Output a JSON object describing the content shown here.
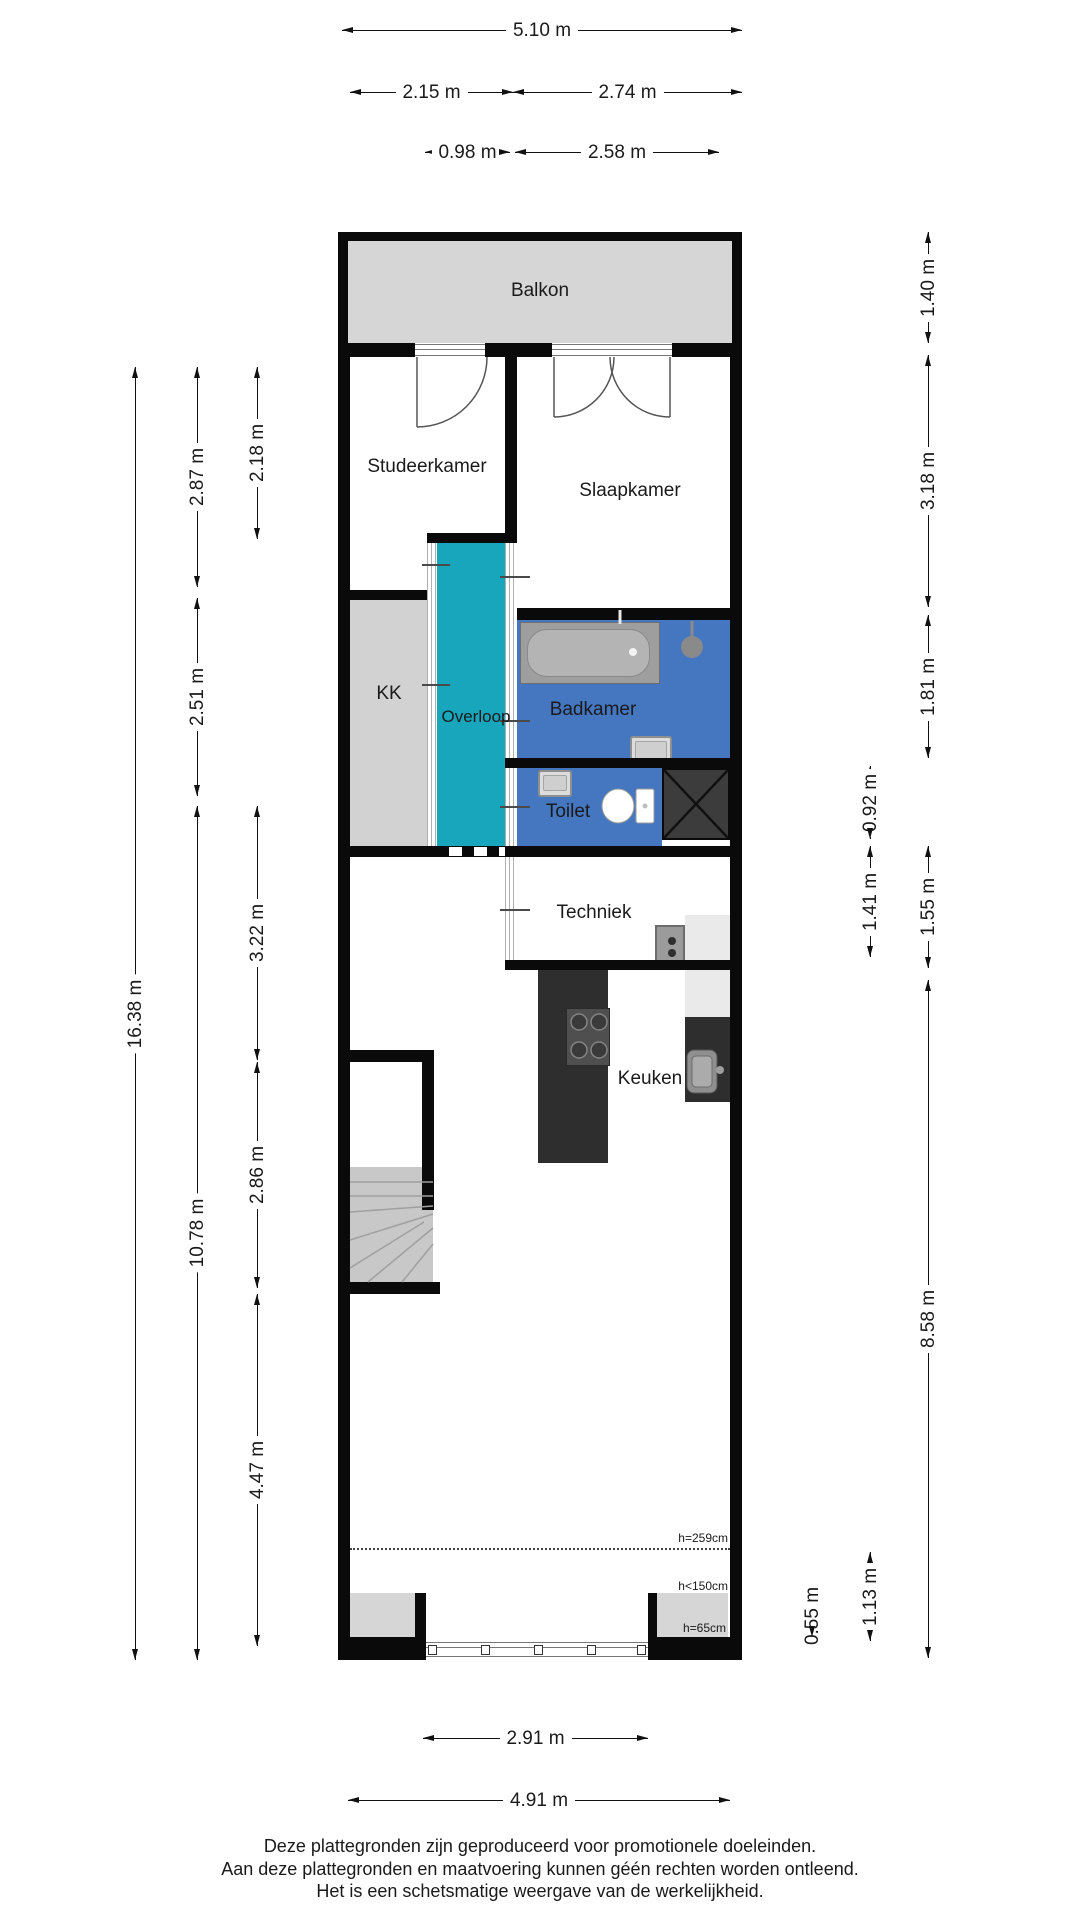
{
  "rooms": {
    "balkon": "Balkon",
    "studeerkamer": "Studeerkamer",
    "slaapkamer": "Slaapkamer",
    "kk": "KK",
    "overloop": "Overloop",
    "badkamer": "Badkamer",
    "toilet": "Toilet",
    "techniek": "Techniek",
    "keuken": "Keuken"
  },
  "dims": {
    "top_total": "5.10 m",
    "top_left": "2.15 m",
    "top_right": "2.74 m",
    "top_inner_left": "0.98 m",
    "top_inner_right": "2.58 m",
    "left_total": "16.38 m",
    "left_upper": "2.87 m",
    "left_mid": "2.51 m",
    "left_lower": "10.78 m",
    "left_inner_top": "2.18 m",
    "left_inner_mid": "3.22 m",
    "left_inner_stairs": "2.86 m",
    "left_inner_bottom": "4.47 m",
    "right_balcony": "1.40 m",
    "right_bedroom": "3.18 m",
    "right_bathroom": "1.81 m",
    "right_toilet": "0.92 m",
    "right_techniek": "1.41 m",
    "right_hall": "1.55 m",
    "right_living": "8.58 m",
    "right_front": "1.13 m",
    "right_sill": "0.55 m",
    "bottom_window": "2.91 m",
    "bottom_total": "4.91 m"
  },
  "height_labels": {
    "ceiling": "h=259cm",
    "low": "h<150cm",
    "sill": "h=65cm"
  },
  "footer": {
    "line1": "Deze plattegronden zijn geproduceerd voor promotionele doeleinden.",
    "line2": "Aan deze plattegronden en maatvoering kunnen géén rechten worden ontleend.",
    "line3": "Het is een schetsmatige weergave van de werkelijkheid."
  },
  "colors": {
    "wall": "#0a0a0a",
    "balcony_floor": "#d6d6d6",
    "kk_floor": "#d2d2d2",
    "hallway_floor": "#17a6bc",
    "bathroom_floor": "#4577c0",
    "counter_dark": "#2e2e2e",
    "stairs": "#c8c8c8",
    "shaft": "#3c3c3c"
  }
}
